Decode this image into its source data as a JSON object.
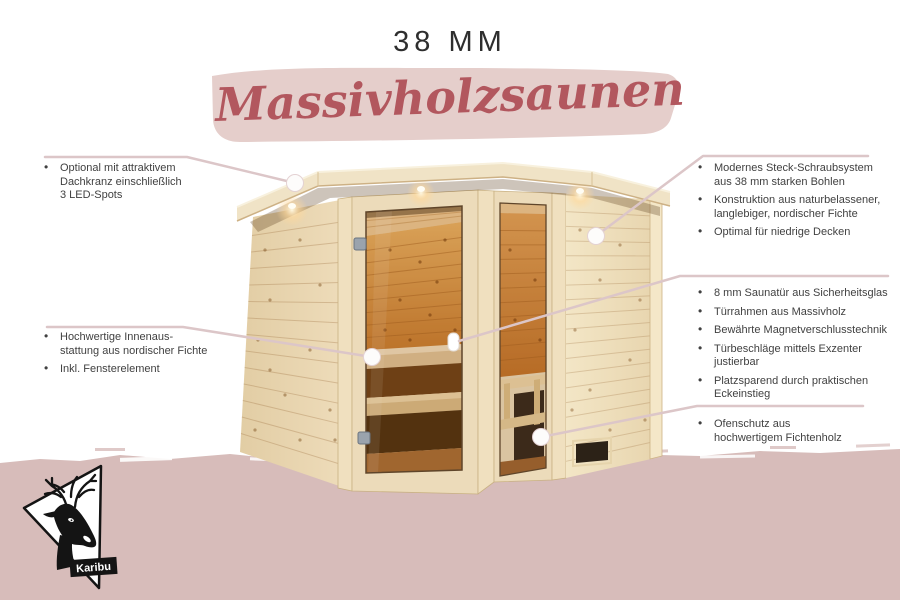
{
  "header": {
    "title": "38 MM",
    "banner_text": "Massivholzsaunen"
  },
  "annotations": {
    "left": [
      {
        "items": [
          "Optional mit attraktivem\nDachkranz einschließlich\n3 LED-Spots"
        ]
      },
      {
        "items": [
          "Hochwertige Innenaus-\nstattung aus nordischer Fichte",
          "Inkl. Fensterelement"
        ]
      }
    ],
    "right": [
      {
        "items": [
          "Modernes Steck-Schraubsystem\naus 38 mm starken Bohlen",
          "Konstruktion aus naturbelassener,\nlanglebiger, nordischer Fichte",
          "Optimal für niedrige Decken"
        ]
      },
      {
        "items": [
          "8 mm Saunatür aus Sicherheitsglas",
          "Türrahmen aus Massivholz",
          "Bewährte Magnetverschlusstechnik",
          "Türbeschläge mittels Exzenter\njustierbar",
          "Platzsparend durch praktischen\nEckeinstieg"
        ]
      },
      {
        "items": [
          "Ofenschutz aus\nhochwertigem Fichtenholz"
        ]
      }
    ]
  },
  "logo": {
    "brand": "Karibu"
  },
  "colors": {
    "band_pink": "#d7bcba",
    "banner_pink": "#e5cecb",
    "script_red": "#b2575e",
    "connector_line": "#dcc6c8",
    "text": "#414141",
    "logo_black": "#141414"
  }
}
